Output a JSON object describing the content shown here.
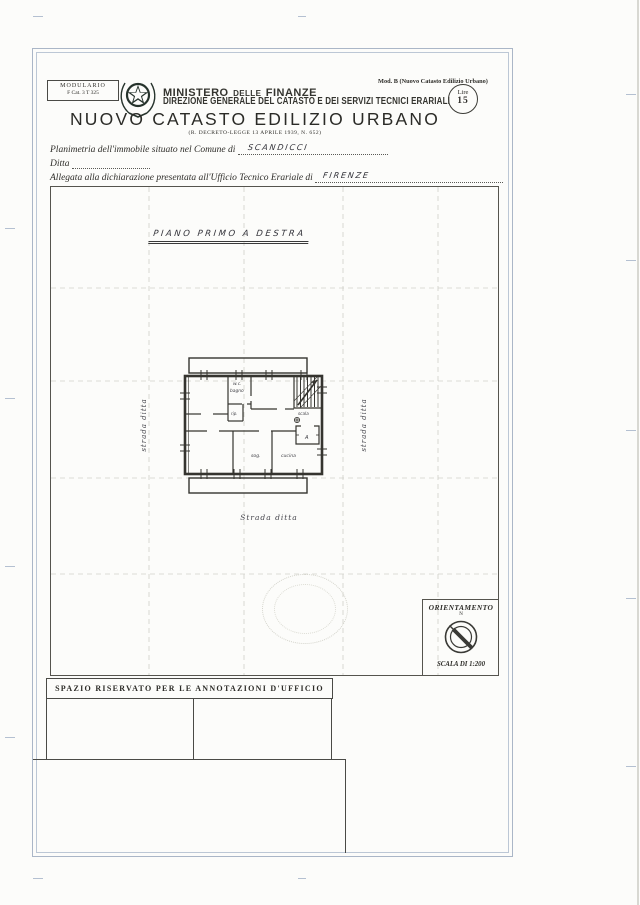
{
  "colors": {
    "ink": "#2e2d29",
    "frame_blue": "#aab6c7",
    "handwriting": "#33333a"
  },
  "header": {
    "modulario": {
      "title": "MODULARIO",
      "code": "F  Cat. 3 T  325"
    },
    "mod_ref": "Mod. B (Nuovo Catasto Edilizio Urbano)",
    "fee_stamp": {
      "currency": "Lire",
      "amount": "15"
    },
    "ministry": {
      "part1": "MINISTERO",
      "part2": "DELLE",
      "part3": "FINANZE"
    },
    "directorate": "DIREZIONE GENERALE DEL CATASTO E DEI SERVIZI TECNICI ERARIALI",
    "title": "NUOVO CATASTO EDILIZIO URBANO",
    "law_reference": "(R. DECRETO-LEGGE 13 APRILE 1939, N. 652)"
  },
  "form": {
    "comune_label": "Planimetria dell'immobile situato nel Comune di",
    "comune_value": "SCANDICCI",
    "ditta_label": "Ditta",
    "ufficio_label": "Allegata alla dichiarazione presentata all'Ufficio Tecnico Erariale di",
    "ufficio_value": "FIRENZE"
  },
  "drawing": {
    "caption": "PIANO PRIMO A DESTRA",
    "boundary_labels": {
      "left": "strada ditta",
      "right": "strada ditta",
      "bottom": "Strada ditta"
    },
    "room_labels": {
      "wc": "w.c.",
      "bagno": "bagno",
      "rip": "rip.",
      "scala": "scala",
      "vestibule": "A",
      "sog": "sog.",
      "cucina": "cucina"
    },
    "orientation": {
      "title": "ORIENTAMENTO",
      "north_label": "N",
      "scale": "SCALA DI 1:200"
    }
  },
  "annotations": {
    "header": "SPAZIO RISERVATO PER LE ANNOTAZIONI D'UFFICIO"
  }
}
